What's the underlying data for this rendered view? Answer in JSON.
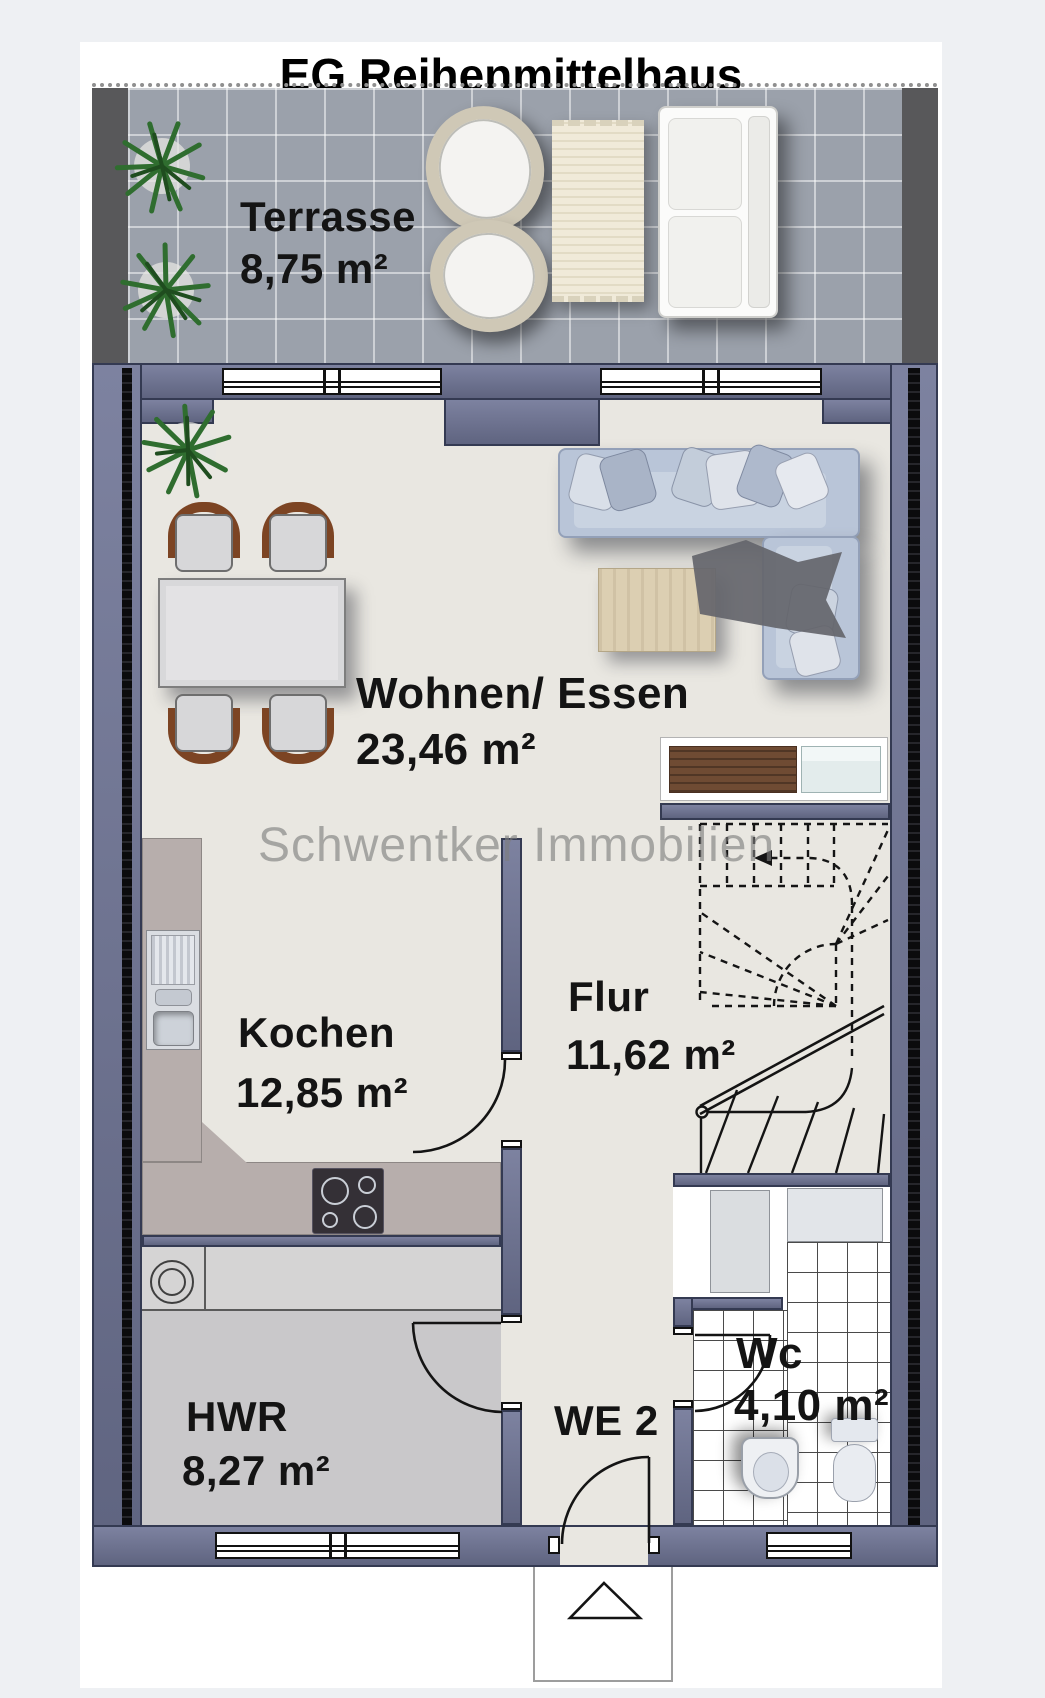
{
  "title": "EG Reihenmittelhaus",
  "watermark": "Schwentker Immobilien",
  "floor_plan": {
    "unit_label": "WE 2",
    "rooms": {
      "terrasse": {
        "name": "Terrasse",
        "area": "8,75 m²"
      },
      "wohnen": {
        "name": "Wohnen/ Essen",
        "area": "23,46 m²"
      },
      "kochen": {
        "name": "Kochen",
        "area": "12,85 m²"
      },
      "flur": {
        "name": "Flur",
        "area": "11,62 m²"
      },
      "hwr": {
        "name": "HWR",
        "area": "8,27 m²"
      },
      "wc": {
        "name": "Wc",
        "area": "4,10 m²"
      }
    },
    "furniture": [
      "plant",
      "round-chair",
      "outdoor-mat",
      "outdoor-sofa",
      "corner-sofa",
      "pillows",
      "throw-blanket",
      "coffee-table",
      "dining-table",
      "dining-chairs",
      "sideboard",
      "kitchen-counter",
      "kitchen-sink",
      "cooktop",
      "worktop",
      "washing-machine",
      "wardrobe-cabinet",
      "wc-sink",
      "toilet",
      "staircase",
      "entrance-arrow"
    ],
    "colors": {
      "wall": "#6a6f8b",
      "party_wall_insulation": "#0b0b0d",
      "floor": "#e9e7e1",
      "terrace_tile": "#9ba1ab",
      "kitchen_counter": "#b7aeac",
      "hwr_floor": "#c9c8ca",
      "sofa": "#b9c5d8",
      "line": "#141414"
    }
  }
}
